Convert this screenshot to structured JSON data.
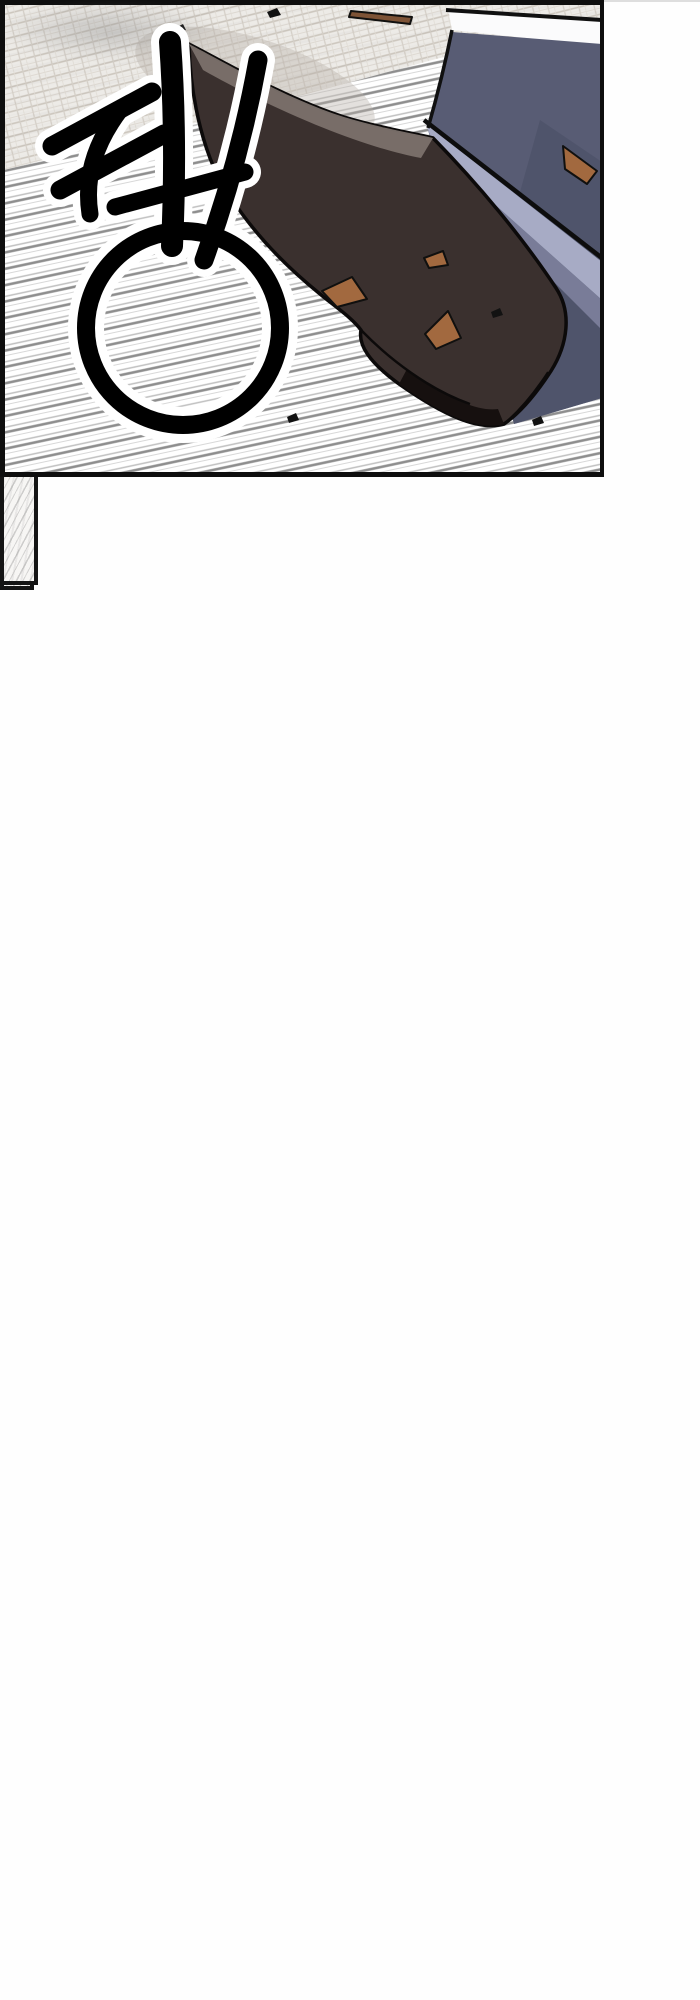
{
  "page": {
    "kind": "webtoon page",
    "background": "#fefefe",
    "divider_color": "#dedede"
  },
  "watermark": {
    "tagline": "가장 빠른 웹툰 미리보기",
    "brand": "구글검색 뉴토끼",
    "text_color": "#c8c8c8",
    "mascot": "rabbit-girl-mascot"
  },
  "sfx": {
    "text": "쾅",
    "color": "#000000",
    "outline": "#ffffff"
  },
  "art_colors": {
    "boot": "#3a302e",
    "boot_highlight": "#7b716c",
    "sole": "#16100f",
    "pants": "#585c74",
    "pants_light": "#a7abc5",
    "debris": "#a2693f",
    "outline": "#0e0e0e",
    "speed_line": "#8e8e8e",
    "floor_grid": "#c9c3ba"
  }
}
